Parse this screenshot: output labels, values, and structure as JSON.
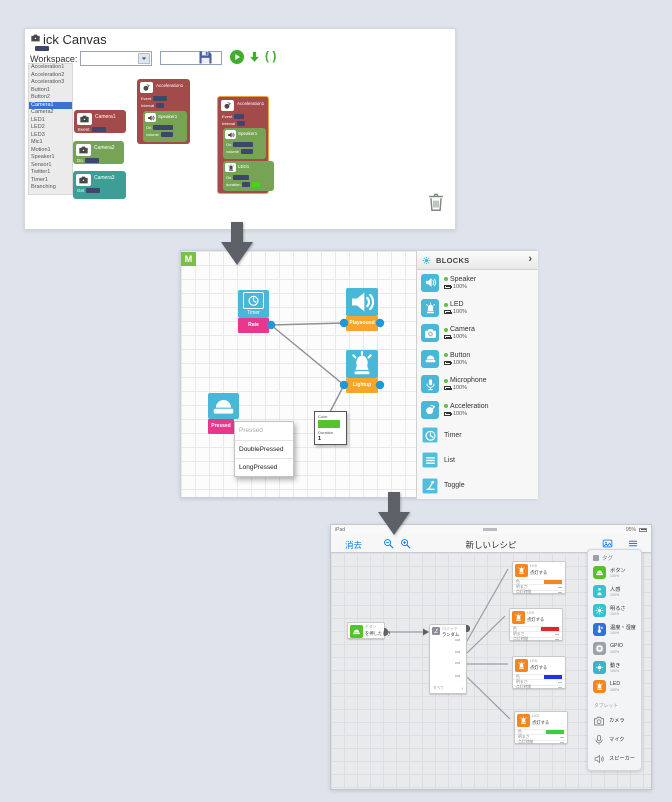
{
  "colors": {
    "page_bg": "#dee3ec",
    "brick_red": "#a34a4a",
    "brick_green": "#77a355",
    "brick_teal": "#3d9e96",
    "brick_purple": "#8a63a8",
    "mesh_teal": "#49b8d8",
    "mesh_pink": "#e8378c",
    "mesh_orange": "#f7a62a",
    "port_blue": "#1e98d8",
    "toolbar_green": "#3fae29",
    "ios_blue": "#0a7cff",
    "led_orange": "#f5861f"
  },
  "top": {
    "title": "Brick Canvas",
    "toolbar": {
      "workspace_label": "Workspace:",
      "workspace_value": "",
      "filename_value": "",
      "braces_label": "( )"
    },
    "sidebar": {
      "selected_index": 5,
      "items": [
        "Acceleration1",
        "Acceleration2",
        "Acceleration3",
        "Button1",
        "Button2",
        "Camera1",
        "Camera2",
        "LED1",
        "LED2",
        "LED3",
        "Mic1",
        "Motion1",
        "Speaker1",
        "Sensor1",
        "Twitter1",
        "Timer1",
        "Branching"
      ]
    },
    "palette": [
      {
        "title": "Camera1",
        "row": "Event",
        "color": "#a34a4a"
      },
      {
        "title": "Camera2",
        "row": "Do",
        "color": "#77a355"
      },
      {
        "title": "Camera3",
        "row": "Get",
        "color": "#3d9e96"
      },
      {
        "title": "Camera4",
        "row": "Is",
        "color": "#8a63a8"
      }
    ],
    "accel_block_1": {
      "title": "Acceleration1",
      "row1": "Event",
      "row2": "Interval",
      "speaker_title": "Speaker1",
      "speaker_row1": "On",
      "speaker_row2": "volume"
    },
    "accel_block_2": {
      "title": "Acceleration1",
      "row1": "Event",
      "row2": "Interval",
      "speaker_title": "Speaker1",
      "speaker_row1": "On",
      "speaker_row2": "volume",
      "led_title": "LED1",
      "led_row1": "On",
      "led_row2": "duration",
      "led_swatch": "#3bdb10"
    }
  },
  "mid": {
    "logo": "M",
    "blocks": {
      "timer": {
        "caption": "Timer",
        "sub": "Rate"
      },
      "speaker": {
        "caption": "Speaker",
        "sub": "Playsound"
      },
      "led": {
        "caption": "LED",
        "sub": "Lightup"
      },
      "button": {
        "caption": "Button",
        "sub": "Pressed"
      }
    },
    "menu": [
      "Pressed",
      "DoublePressed",
      "LongPressed"
    ],
    "propbox": {
      "color_label": "Color",
      "swatch": "#56c22d",
      "duration_label": "Duration",
      "duration_value": "1"
    },
    "panel": {
      "title": "BLOCKS",
      "chevron": "›",
      "items": [
        {
          "name": "Speaker",
          "icon": "speaker",
          "battery": "100%",
          "online": true,
          "variant": "solid"
        },
        {
          "name": "LED",
          "icon": "led",
          "battery": "100%",
          "online": true,
          "variant": "solid"
        },
        {
          "name": "Camera",
          "icon": "camera",
          "battery": "100%",
          "online": true,
          "variant": "solid"
        },
        {
          "name": "Button",
          "icon": "button",
          "battery": "100%",
          "online": true,
          "variant": "solid"
        },
        {
          "name": "Microphone",
          "icon": "mic",
          "battery": "100%",
          "online": true,
          "variant": "solid"
        },
        {
          "name": "Acceleration",
          "icon": "acceleration",
          "battery": "100%",
          "online": true,
          "variant": "solid"
        },
        {
          "name": "Timer",
          "icon": "timer",
          "online": false,
          "variant": "outline"
        },
        {
          "name": "List",
          "icon": "list",
          "online": false,
          "variant": "outline"
        },
        {
          "name": "Toggle",
          "icon": "toggle",
          "online": false,
          "variant": "outline"
        }
      ]
    }
  },
  "bottom": {
    "status": {
      "device": "iPad",
      "battery": "95%"
    },
    "nav": {
      "erase": "消去",
      "title": "新しいレシピ"
    },
    "button_block": {
      "caption": "ボタン",
      "label": "を押したとき",
      "color": "#53c22b",
      "icon": "button"
    },
    "logic_block": {
      "caption": "ロジック",
      "label": "ランダム",
      "ports": [
        "out",
        "out",
        "out",
        "out"
      ],
      "footer": "すべて",
      "chevron": "›"
    },
    "led_blocks": [
      {
        "caption": "LED",
        "label": "点灯する",
        "row_color": "色",
        "row_brightness": "明るさ",
        "row_duration": "点灯時間",
        "color": "#f5861f"
      },
      {
        "caption": "LED",
        "label": "点灯する",
        "row_color": "色",
        "row_brightness": "明るさ",
        "row_duration": "点灯時間",
        "color": "#e8242b"
      },
      {
        "caption": "LED",
        "label": "点灯する",
        "row_color": "色",
        "row_brightness": "明るさ",
        "row_duration": "点灯時間",
        "color": "#2430e8"
      },
      {
        "caption": "LED",
        "label": "点灯する",
        "row_color": "色",
        "row_brightness": "明るさ",
        "row_duration": "点灯時間",
        "color": "#39cf3a"
      }
    ],
    "panel": {
      "title": "タグ",
      "items": [
        {
          "label": "ボタン",
          "sub": "100%",
          "color": "#53c22b",
          "icon": "button"
        },
        {
          "label": "人感",
          "sub": "100%",
          "color": "#35c3cf",
          "icon": "human"
        },
        {
          "label": "明るさ",
          "sub": "100%",
          "color": "#35c3cf",
          "icon": "brightness"
        },
        {
          "label": "温度・湿度",
          "sub": "100%",
          "color": "#2f72d9",
          "icon": "temperature"
        },
        {
          "label": "GPIO",
          "sub": "100%",
          "color": "#9aa0a8",
          "icon": "gpio"
        },
        {
          "label": "動き",
          "sub": "100%",
          "color": "#35b6c9",
          "icon": "motion"
        },
        {
          "label": "LED",
          "sub": "100%",
          "color": "#f5861f",
          "icon": "led"
        }
      ],
      "section": "タブレット",
      "tablet_items": [
        {
          "label": "カメラ",
          "icon": "camera-outline"
        },
        {
          "label": "マイク",
          "icon": "mic-outline"
        },
        {
          "label": "スピーカー",
          "icon": "speaker-outline"
        }
      ]
    }
  }
}
